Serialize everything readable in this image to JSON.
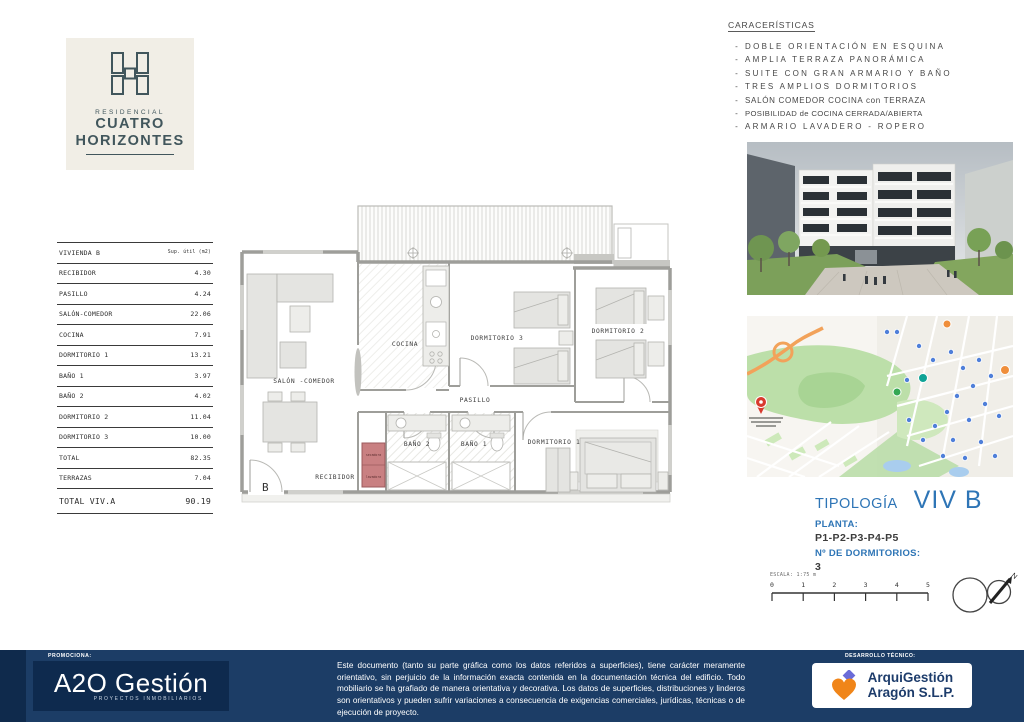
{
  "brand": {
    "tagline": "RESIDENCIAL",
    "line1": "CUATRO",
    "line2": "HORIZONTES"
  },
  "surface_table": {
    "unit": "VIVIENDA B",
    "sup_header": "Sup. útil (m2)",
    "rows": [
      {
        "label": "RECIBIDOR",
        "value": "4.30"
      },
      {
        "label": "PASILLO",
        "value": "4.24"
      },
      {
        "label": "SALÓN-COMEDOR",
        "value": "22.06"
      },
      {
        "label": "COCINA",
        "value": "7.91"
      },
      {
        "label": "DORMITORIO 1",
        "value": "13.21"
      },
      {
        "label": "BAÑO 1",
        "value": "3.97"
      },
      {
        "label": "BAÑO 2",
        "value": "4.02"
      },
      {
        "label": "DORMITORIO 2",
        "value": "11.04"
      },
      {
        "label": "DORMITORIO 3",
        "value": "10.00"
      },
      {
        "label": "TOTAL",
        "value": "82.35"
      },
      {
        "label": "TERRAZAS",
        "value": "7.04"
      },
      {
        "label": "TOTAL VIV.A",
        "value": "90.19"
      }
    ]
  },
  "caracteristicas": {
    "title": "CARACERÍSTICAS",
    "items": [
      "DOBLE ORIENTACIÓN EN ESQUINA",
      "AMPLIA TERRAZA PANORÁMICA",
      "SUITE CON GRAN ARMARIO Y BAÑO",
      "TRES AMPLIOS DORMITORIOS",
      "SALÓN COMEDOR COCINA con TERRAZA",
      "POSIBILIDAD de COCINA CERRADA/ABIERTA",
      "ARMARIO LAVADERO - ROPERO"
    ]
  },
  "floorplan": {
    "rooms": {
      "salon": "SALÓN -COMEDOR",
      "cocina": "COCINA",
      "dorm3": "DORMITORIO 3",
      "dorm2": "DORMITORIO 2",
      "pasillo": "PASILLO",
      "bano2": "BAÑO 2",
      "bano1": "BAÑO 1",
      "dorm1": "DORMITORIO 1",
      "recibidor": "RECIBIDOR"
    },
    "laundry": {
      "top": "secadora",
      "bottom": "lavadora"
    },
    "corner_letter": "B"
  },
  "tipologia": {
    "label": "TIPOLOGÍA",
    "value": "VIV B",
    "planta_label": "PLANTA:",
    "planta_value": "P1-P2-P3-P4-P5",
    "dorm_label": "Nº DE DORMITORIOS:",
    "dorm_value": "3"
  },
  "scale_bar": {
    "label": "ESCALA: 1:75 m",
    "ticks": [
      "0",
      "1",
      "2",
      "3",
      "4",
      "5"
    ],
    "north_label": "N"
  },
  "footer": {
    "promociona_label": "PROMOCIONA:",
    "promotora_logo": {
      "name": "A2O Gestión",
      "sub": "PROYECTOS INMOBILIARIOS"
    },
    "disclaimer": "Este documento (tanto su parte gráfica como los datos referidos a superficies), tiene carácter meramente orientativo, sin perjuicio de la información exacta contenida en la documentación técnica del edificio. Todo mobiliario se ha grafiado de manera orientativa y decorativa. Los datos de superficies, distribuciones y linderos son orientativos y pueden sufrir variaciones a consecuencia de exigencias comerciales, jurídicas, técnicas o de ejecución de proyecto.",
    "desarrollo_label": "DESARROLLO TÉCNICO:",
    "tecnico_logo": {
      "line1": "ArquiGestión",
      "line2": "Aragón S.L.P."
    }
  },
  "colors": {
    "accent_blue": "#2e75b6",
    "footer_navy": "#1c3d66",
    "logo_slate": "#41565c",
    "logo_cream": "#f1eee6",
    "laundry_red": "#c98082"
  }
}
